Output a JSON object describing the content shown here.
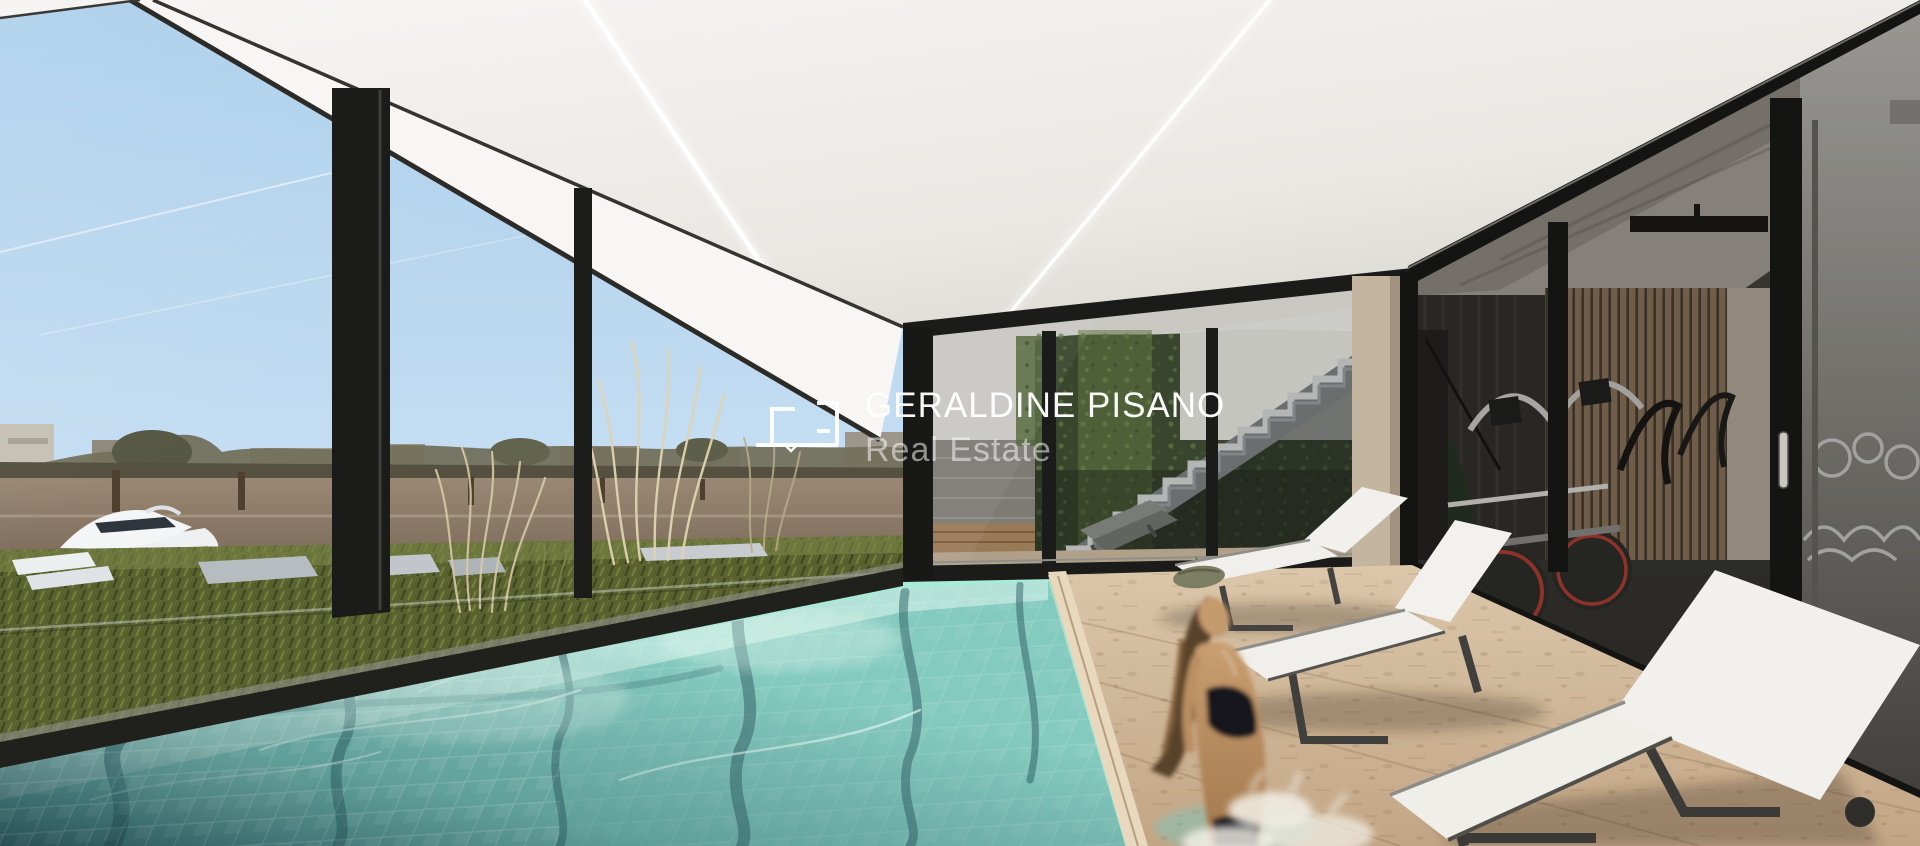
{
  "watermark": {
    "title": "GERALDINE PISANO",
    "subtitle": "Real Estate",
    "logo_name": "geraldine-pisano-monogram",
    "text_color": "#ffffff"
  },
  "scene": {
    "type": "architectural-render",
    "description": "Indoor lap pool pavilion with floor-to-ceiling glazing, river marina view, outdoor courtyard stair with ivy wall, travertine deck with sun loungers, glazed gym, woman exiting the pool",
    "elements": [
      "sky",
      "contrails",
      "river",
      "yacht",
      "mooring-posts",
      "shore-buildings",
      "treeline",
      "grass-bank",
      "ornamental-grasses",
      "stone-slabs",
      "glass-wall",
      "window-mullions",
      "ceiling",
      "led-strip-lights",
      "courtyard",
      "ivy-wall",
      "brick-pier",
      "concrete-stair",
      "wood-deck",
      "courtyard-loungers",
      "swimming-pool",
      "pool-tiles",
      "waterline",
      "travertine-deck",
      "pool-coping",
      "sun-lounger",
      "rolled-towel",
      "gym",
      "wood-slat-wall",
      "elliptical-trainer",
      "exercise-bikes",
      "glass-door-handle",
      "woman-in-pool",
      "water-splash"
    ],
    "palette": {
      "sky_top": "#a9cdea",
      "sky_bottom": "#ddeefb",
      "ceiling": "#f2f1ee",
      "river": "#8b7a67",
      "grass": "#5a6230",
      "pool_shallow": "#bfe7df",
      "pool_mid": "#85cabf",
      "pool_deep": "#1c4450",
      "waterline": "#a5ecd8",
      "travertine": "#d2bb9e",
      "coping": "#e8d8bd",
      "lounger_fabric": "#f0efeb",
      "lounger_frame": "#44433f",
      "gym_glass": "#33322d",
      "wood_slats": "#8a7158",
      "stair": "#ced1ce",
      "ivy": "#3d4a2e",
      "frame_black": "#1b1c1a",
      "accent_red": "#b03b30",
      "skin": "#c49a6e",
      "bikini": "#15151a"
    }
  }
}
